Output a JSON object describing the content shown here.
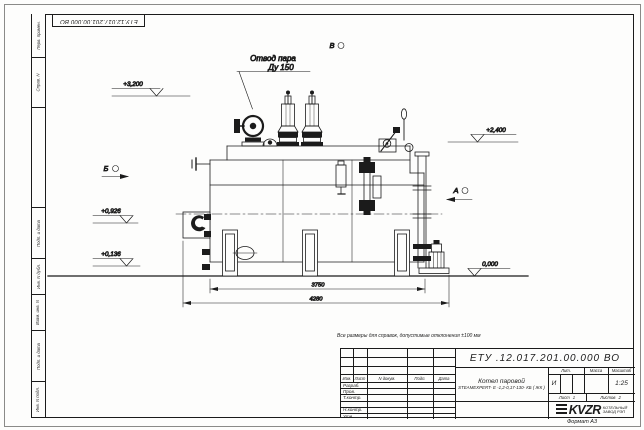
{
  "sheet": {
    "doc_number": "ЕТУ.12.017.201.00.000 ВО",
    "note": "Все размеры для справок, допустимые отклонения ±100 мм",
    "format_label": "Формат А3"
  },
  "margin_columns": [
    "Перв. примен.",
    "Справ. N",
    "",
    "Подп. и дата",
    "Инв. N дубл.",
    "Взам. инв. N",
    "Подп. и дата",
    "Инв. N подл."
  ],
  "annotations": {
    "steam_outlet_line1": "Отвод пара",
    "steam_outlet_line2": "Ду 150",
    "view_v": "В",
    "view_b": "Б",
    "view_a": "А",
    "elev_3200": "+3,200",
    "elev_2400": "+2,400",
    "elev_0926": "+0,926",
    "elev_0136": "+0,136",
    "elev_0000": "0,000"
  },
  "dimensions": {
    "boiler_length": "3750",
    "overall_length": "4280"
  },
  "title_block": {
    "designation": "ЕТУ .12.017.201.00.000  ВО",
    "columns": [
      "Изм.",
      "Лист",
      "N докум.",
      "Подп.",
      "Дата"
    ],
    "sign_rows": [
      "Разраб.",
      "Пров.",
      "Т.контр.",
      "",
      "Н.контр.",
      "Утв."
    ],
    "product_line1": "Котел паровой",
    "product_line2": "STEAMEXPERT- Е -1,2-0,17-130- КБ ( ЖК )",
    "lit_header": "Лит.",
    "mass_header": "Масса",
    "scale_header": "Масштаб",
    "lit_value": "И",
    "scale_value": "1:25",
    "sheet_label": "Лист",
    "sheet_value": "1",
    "sheets_label": "Листов",
    "sheets_value": "2",
    "logo_text": "KVZR",
    "company_line1": "КОТЕЛЬНЫЙ",
    "company_line2": "ЗАВОД РЭП"
  }
}
